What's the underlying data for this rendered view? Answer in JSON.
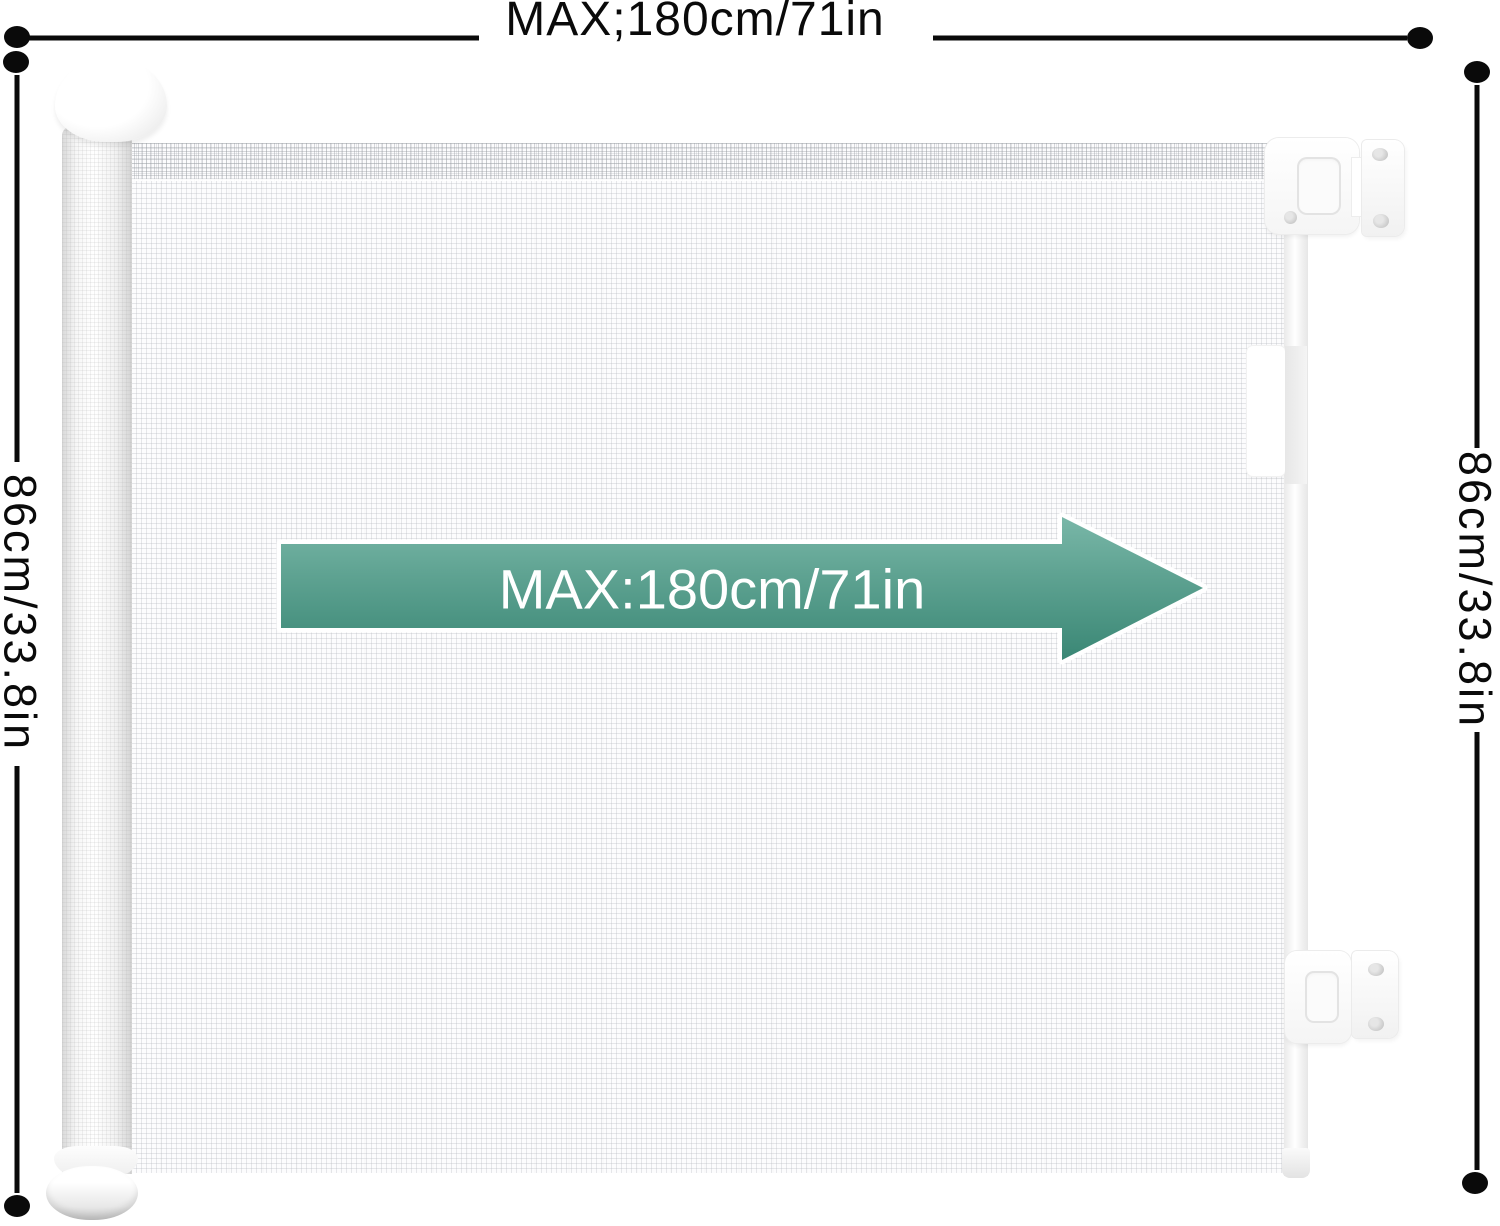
{
  "labels": {
    "top_width": "MAX;180cm/71in",
    "arrow_width": "MAX:180cm/71in",
    "left_height": "86cm/33.8in",
    "right_height": "86cm/33.8in"
  },
  "colors": {
    "ink": "#0a0a0a",
    "arrow_text": "#ffffff",
    "arrow_gradient_top": "#79b7a8",
    "arrow_gradient_mid": "#5fa392",
    "arrow_gradient_bottom": "#3a8775",
    "arrow_outline": "#ffffff"
  }
}
